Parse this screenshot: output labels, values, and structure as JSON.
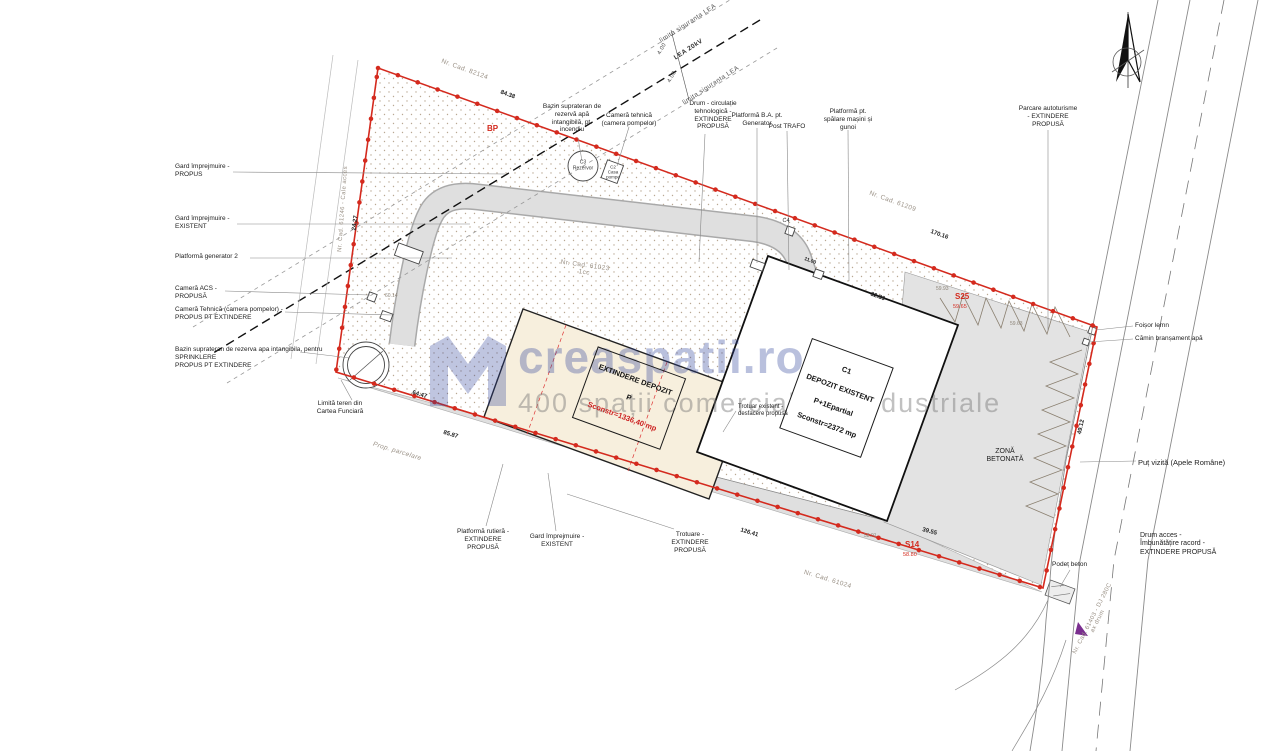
{
  "colors": {
    "boundary_red": "#d42a1e",
    "road_gray": "#dfdfdf",
    "concrete_gray": "#e3e3e3",
    "extindere_fill": "#f7efdd",
    "watermark_blue": "#2a3f98",
    "hatch_dot": "#b9a893"
  },
  "watermark": {
    "brand": "creaspatii.ro",
    "tagline": "400 spații comerciale și industriale",
    "logo": "m-buildings-logo"
  },
  "left": [
    "Gard împrejmuire -\nPROPUS",
    "Gard împrejmuire -\nEXISTENT",
    "Platformă generator 2",
    "Cameră ACS -\nPROPUSĂ",
    "Cameră Tehnică (camera pompelor) -\nPROPUS PT EXTINDERE",
    "Bazin suprateran de rezerva apa intangibila, pentru\nSPRINKLERE\nPROPUS PT EXTINDERE",
    "Limită teren din\nCartea Funciară"
  ],
  "top": [
    "Bazin suprateran de\nrezervă apă\nintangibilă, pt.\nincendiu",
    "Cameră tehnică\n(camera pompelor)",
    "Drum - circulație\ntehnologică -\nEXTINDERE\nPROPUSĂ",
    "Platformă B.A. pt.\nGenerator",
    "Post TRAFO",
    "Platformă pt.\nspălare mașini și\ngunoi",
    "Parcare autoturisme\n- EXTINDERE\nPROPUSĂ"
  ],
  "right": [
    "Foișor lemn",
    "Cămin branșament apă",
    "Puț vizită (Apele Române)",
    "Drum acces -\nÎmbunătățire racord -\nEXTINDERE PROPUSĂ",
    "Podeț beton"
  ],
  "bottom": [
    "Platformă rutieră -\nEXTINDERE\nPROPUSĂ",
    "Gard împrejmuire -\nEXISTENT",
    "Trotuare -\nEXTINDERE\nPROPUSĂ"
  ],
  "buildings": {
    "extindere": {
      "l1": "EXTINDERE DEPOZIT",
      "l2": "P",
      "l3": "Sconstr=1336,40 mp"
    },
    "c1": {
      "l1": "C1",
      "l2": "DEPOZIT EXISTENT",
      "l3": "P+1Epartial",
      "l4": "Sconstr=2372 mp"
    },
    "zona": "ZONĂ\nBETONATĂ",
    "trotuar": "Trotuar existent -\ndesfacere propusă"
  },
  "structures": {
    "c3": "C3\nRezervor",
    "c2": "C2\nCasa\npompe",
    "c4": "C4"
  },
  "lea": {
    "lim1": "limita siguranta LEA",
    "line": "LEA 20kV",
    "lim2": "limita siguranta LEA",
    "d1": "4.00",
    "d2": "4.00"
  },
  "cadastral": [
    "Nr. Cad. 82124",
    "Nr. Cad. 61209",
    "Nr. Cad. 61023\n1cc",
    "Nr. Cad. 61024",
    "Nr. Cad. 61403 - DJ 280C\nax drum",
    "Nr. Cad. 61246 - Cale acces"
  ],
  "misc": {
    "prop_parcelare": "Prop. parcelare"
  },
  "markers": {
    "bp": "BP",
    "s25": "S25",
    "s25_elev": "59.65",
    "s14": "S14",
    "s14_elev": "58.80"
  },
  "dims": [
    "84.38",
    "24.27",
    "170.16",
    "85.87",
    "126.41",
    "39.55",
    "49.12",
    "64.47",
    "32.89",
    "11.00"
  ],
  "elevations": [
    "60.14",
    "59.93",
    "59.63",
    "58.91"
  ]
}
